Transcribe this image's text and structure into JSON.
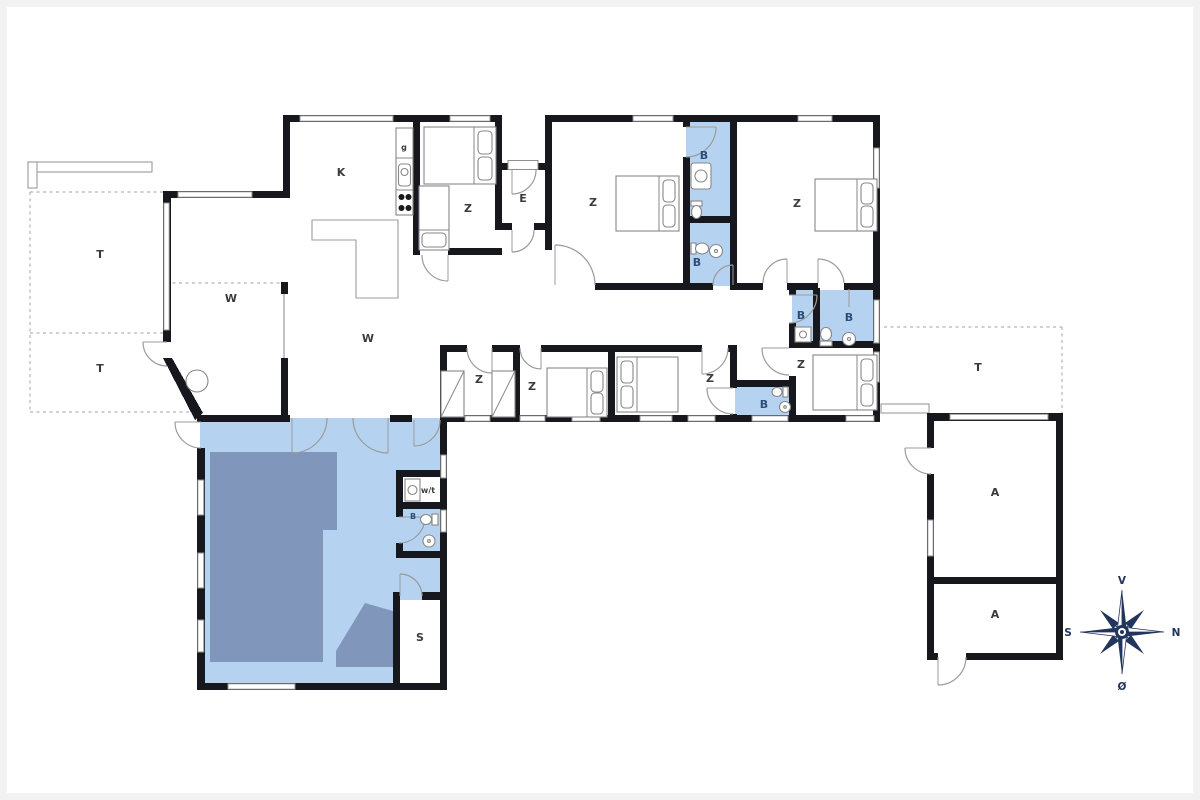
{
  "labels": [
    {
      "id": "terrace-upper-left",
      "text": "T"
    },
    {
      "id": "terrace-lower-left",
      "text": "T"
    },
    {
      "id": "kitchen",
      "text": "K"
    },
    {
      "id": "pantry-cabinet",
      "text": "g"
    },
    {
      "id": "bedroom-1",
      "text": "Z"
    },
    {
      "id": "entry",
      "text": "E"
    },
    {
      "id": "bedroom-2",
      "text": "Z"
    },
    {
      "id": "bathroom-1",
      "text": "B"
    },
    {
      "id": "bathroom-2",
      "text": "B"
    },
    {
      "id": "bedroom-3",
      "text": "Z"
    },
    {
      "id": "living-west",
      "text": "W"
    },
    {
      "id": "living-main",
      "text": "W"
    },
    {
      "id": "bathroom-3",
      "text": "B"
    },
    {
      "id": "bathroom-4",
      "text": "B"
    },
    {
      "id": "bedroom-4",
      "text": "Z"
    },
    {
      "id": "bedroom-5-bunks",
      "text": "Z"
    },
    {
      "id": "bedroom-6",
      "text": "Z"
    },
    {
      "id": "bedroom-7",
      "text": "Z"
    },
    {
      "id": "bathroom-5",
      "text": "B"
    },
    {
      "id": "terrace-east",
      "text": "T"
    },
    {
      "id": "annex-room-upper",
      "text": "A"
    },
    {
      "id": "annex-room-lower",
      "text": "A"
    },
    {
      "id": "utility-washer",
      "text": "w/t"
    },
    {
      "id": "bathroom-pool",
      "text": "B"
    },
    {
      "id": "sauna",
      "text": "S"
    }
  ],
  "compass": {
    "up": "V",
    "right": "N",
    "left": "S",
    "down": "Ø"
  },
  "colors": {
    "wall": "#16181d",
    "room_blue": "#b5d3f0",
    "pool_dark": "#8096ba",
    "label": "#3b3b3b",
    "bath_label": "#2e4d7b",
    "compass": "#22355c"
  }
}
